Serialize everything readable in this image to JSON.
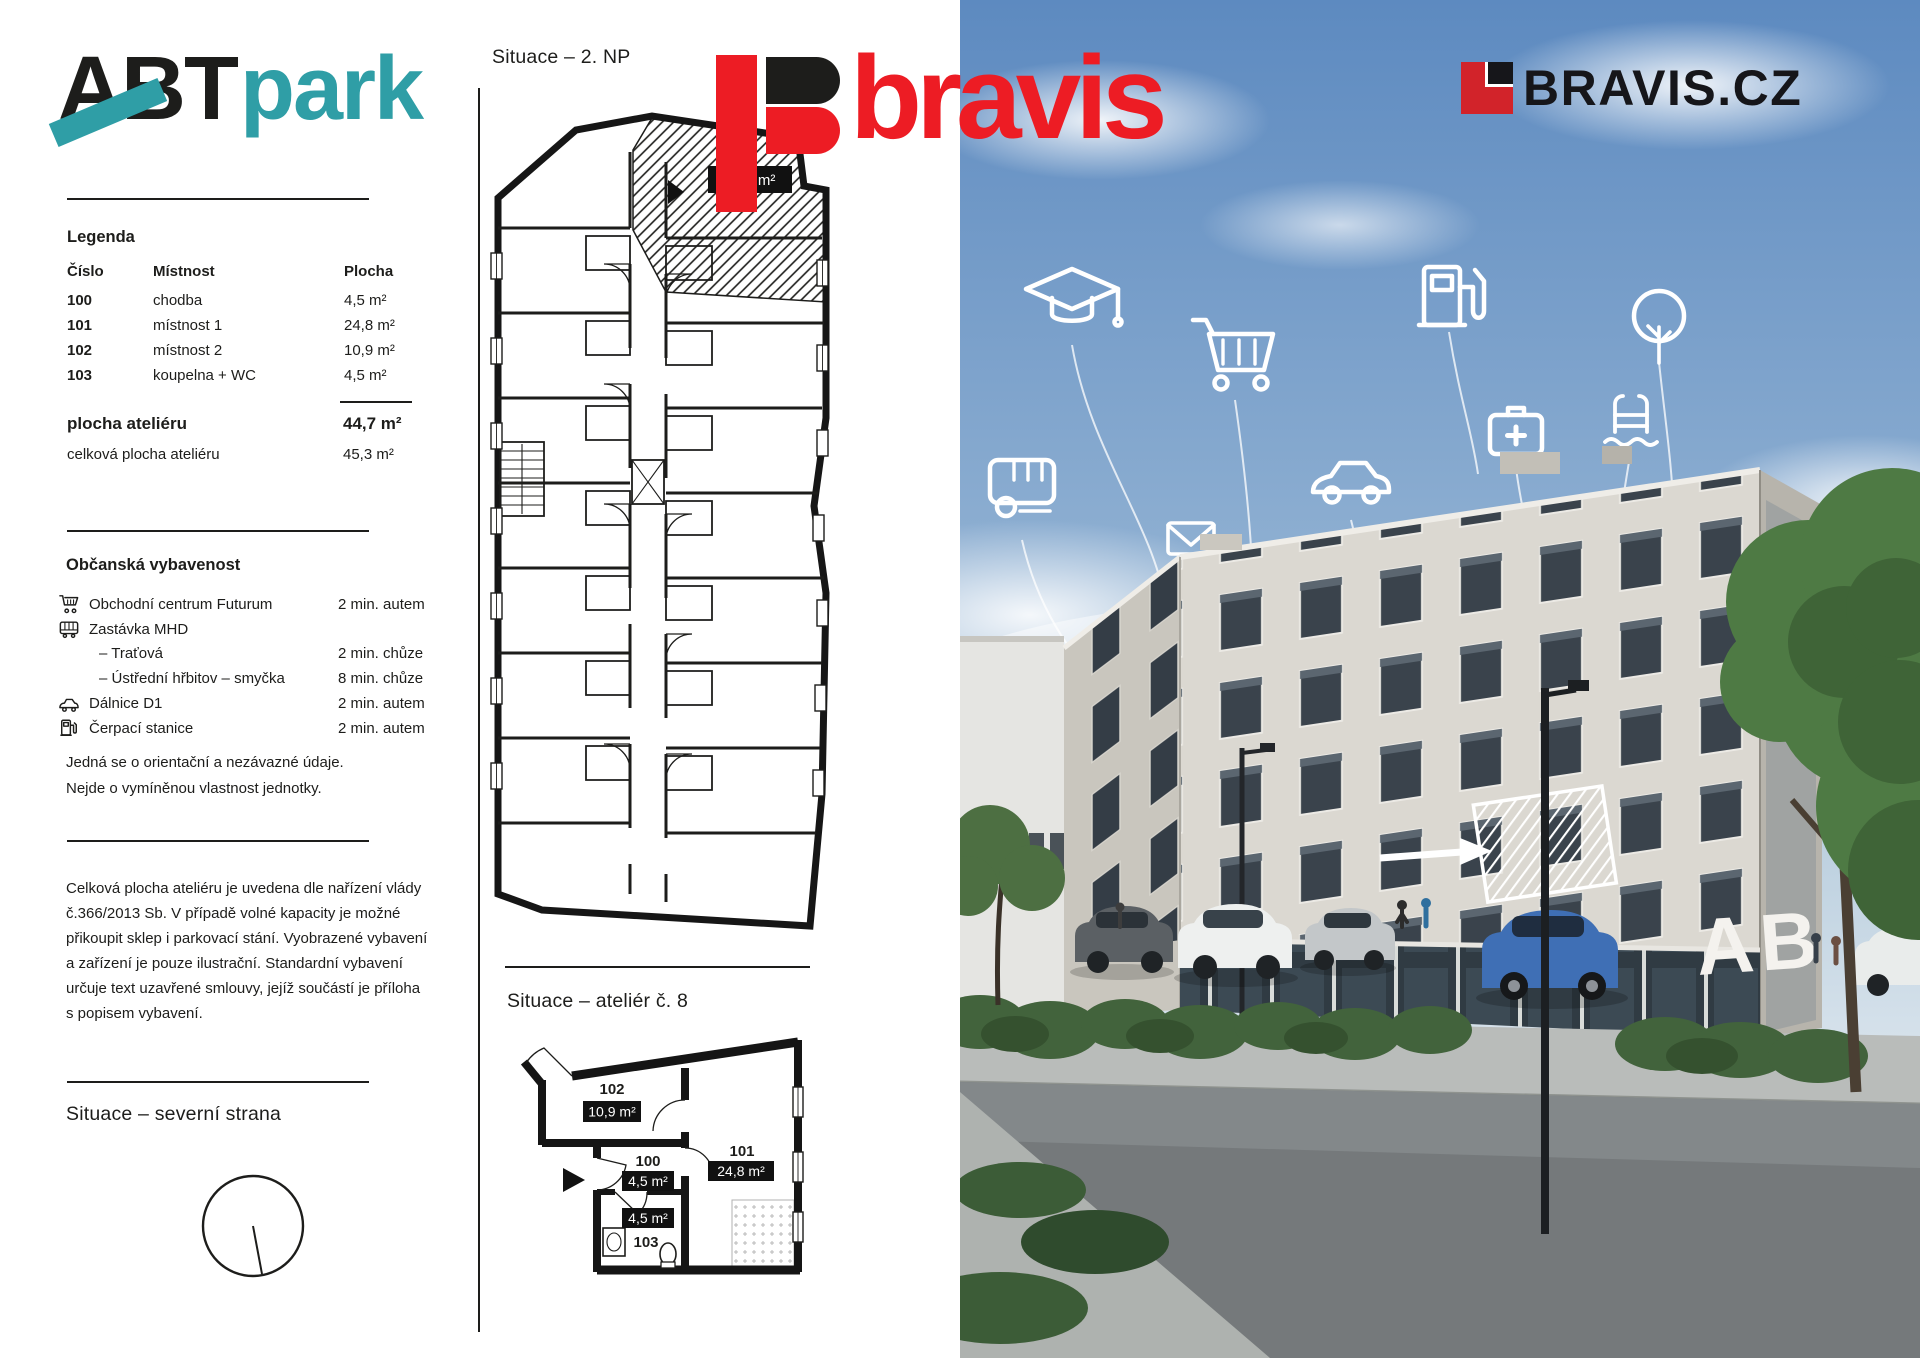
{
  "brand": {
    "abt": "ABT",
    "park": "park"
  },
  "logos": {
    "bravis_word": "bravis",
    "bravis_site": "BRAVIS.CZ"
  },
  "headings": {
    "floor_plan": "Situace – 2. NP",
    "unit_plan": "Situace – ateliér č. 8",
    "north_side": "Situace – severní strana"
  },
  "legend": {
    "title": "Legenda",
    "col_num": "Číslo",
    "col_room": "Místnost",
    "col_area": "Plocha",
    "rows": [
      {
        "num": "100",
        "room": "chodba",
        "area": "4,5 m²"
      },
      {
        "num": "101",
        "room": "místnost 1",
        "area": "24,8 m²"
      },
      {
        "num": "102",
        "room": "místnost 2",
        "area": "10,9 m²"
      },
      {
        "num": "103",
        "room": "koupelna + WC",
        "area": "4,5 m²"
      }
    ],
    "total_label": "plocha ateliéru",
    "total_value": "44,7 m²",
    "gross_label": "celková plocha ateliéru",
    "gross_value": "45,3 m²"
  },
  "amenities": {
    "title": "Občanská vybavenost",
    "items": [
      {
        "icon": "shopping-cart",
        "label": "Obchodní centrum Futurum",
        "value": "2 min. autem"
      },
      {
        "icon": "bus",
        "label": "Zastávka MHD",
        "value": ""
      },
      {
        "icon": "",
        "label": "– Traťová",
        "value": "2 min. chůze"
      },
      {
        "icon": "",
        "label": "– Ústřední hřbitov – smyčka",
        "value": "8 min. chůze"
      },
      {
        "icon": "car",
        "label": "Dálnice D1",
        "value": "2 min. autem"
      },
      {
        "icon": "fuel-pump",
        "label": "Čerpací stanice",
        "value": "2 min. autem"
      }
    ],
    "note_line1": "Jedná se o orientační a nezávazné údaje.",
    "note_line2": "Nejde o vymíněnou vlastnost jednotky."
  },
  "disclaimer_lines": [
    "Celková plocha ateliéru je uvedena dle nařízení vlády",
    "č.366/2013 Sb. V případě volné kapacity je možné",
    "přikoupit sklep i parkovací stání. Vyobrazené vybavení",
    "a zařízení je pouze ilustrační. Standardní vybavení",
    "určuje text uzavřené smlouvy, jejíž součástí je příloha",
    "s popisem vybavení."
  ],
  "floor_plan": {
    "unit_area_badge": "44,7 m²"
  },
  "unit_plan": {
    "room102": {
      "num": "102",
      "area": "10,9 m²"
    },
    "room100": {
      "num": "100",
      "area": "4,5 m²"
    },
    "room101": {
      "num": "101",
      "area": "24,8 m²"
    },
    "room103": {
      "num": "103",
      "area": "4,5 m²"
    }
  },
  "photo": {
    "building_sign": "AB",
    "float_icons": [
      "graduation-cap",
      "shopping-cart",
      "fuel-pump",
      "tree",
      "bus",
      "envelope",
      "car",
      "medical-case",
      "pool-ladder"
    ]
  },
  "colors": {
    "teal": "#2f9ea6",
    "bravis_red": "#ed1c24",
    "logo_red": "#d2232a",
    "ink": "#1d1d1b"
  }
}
